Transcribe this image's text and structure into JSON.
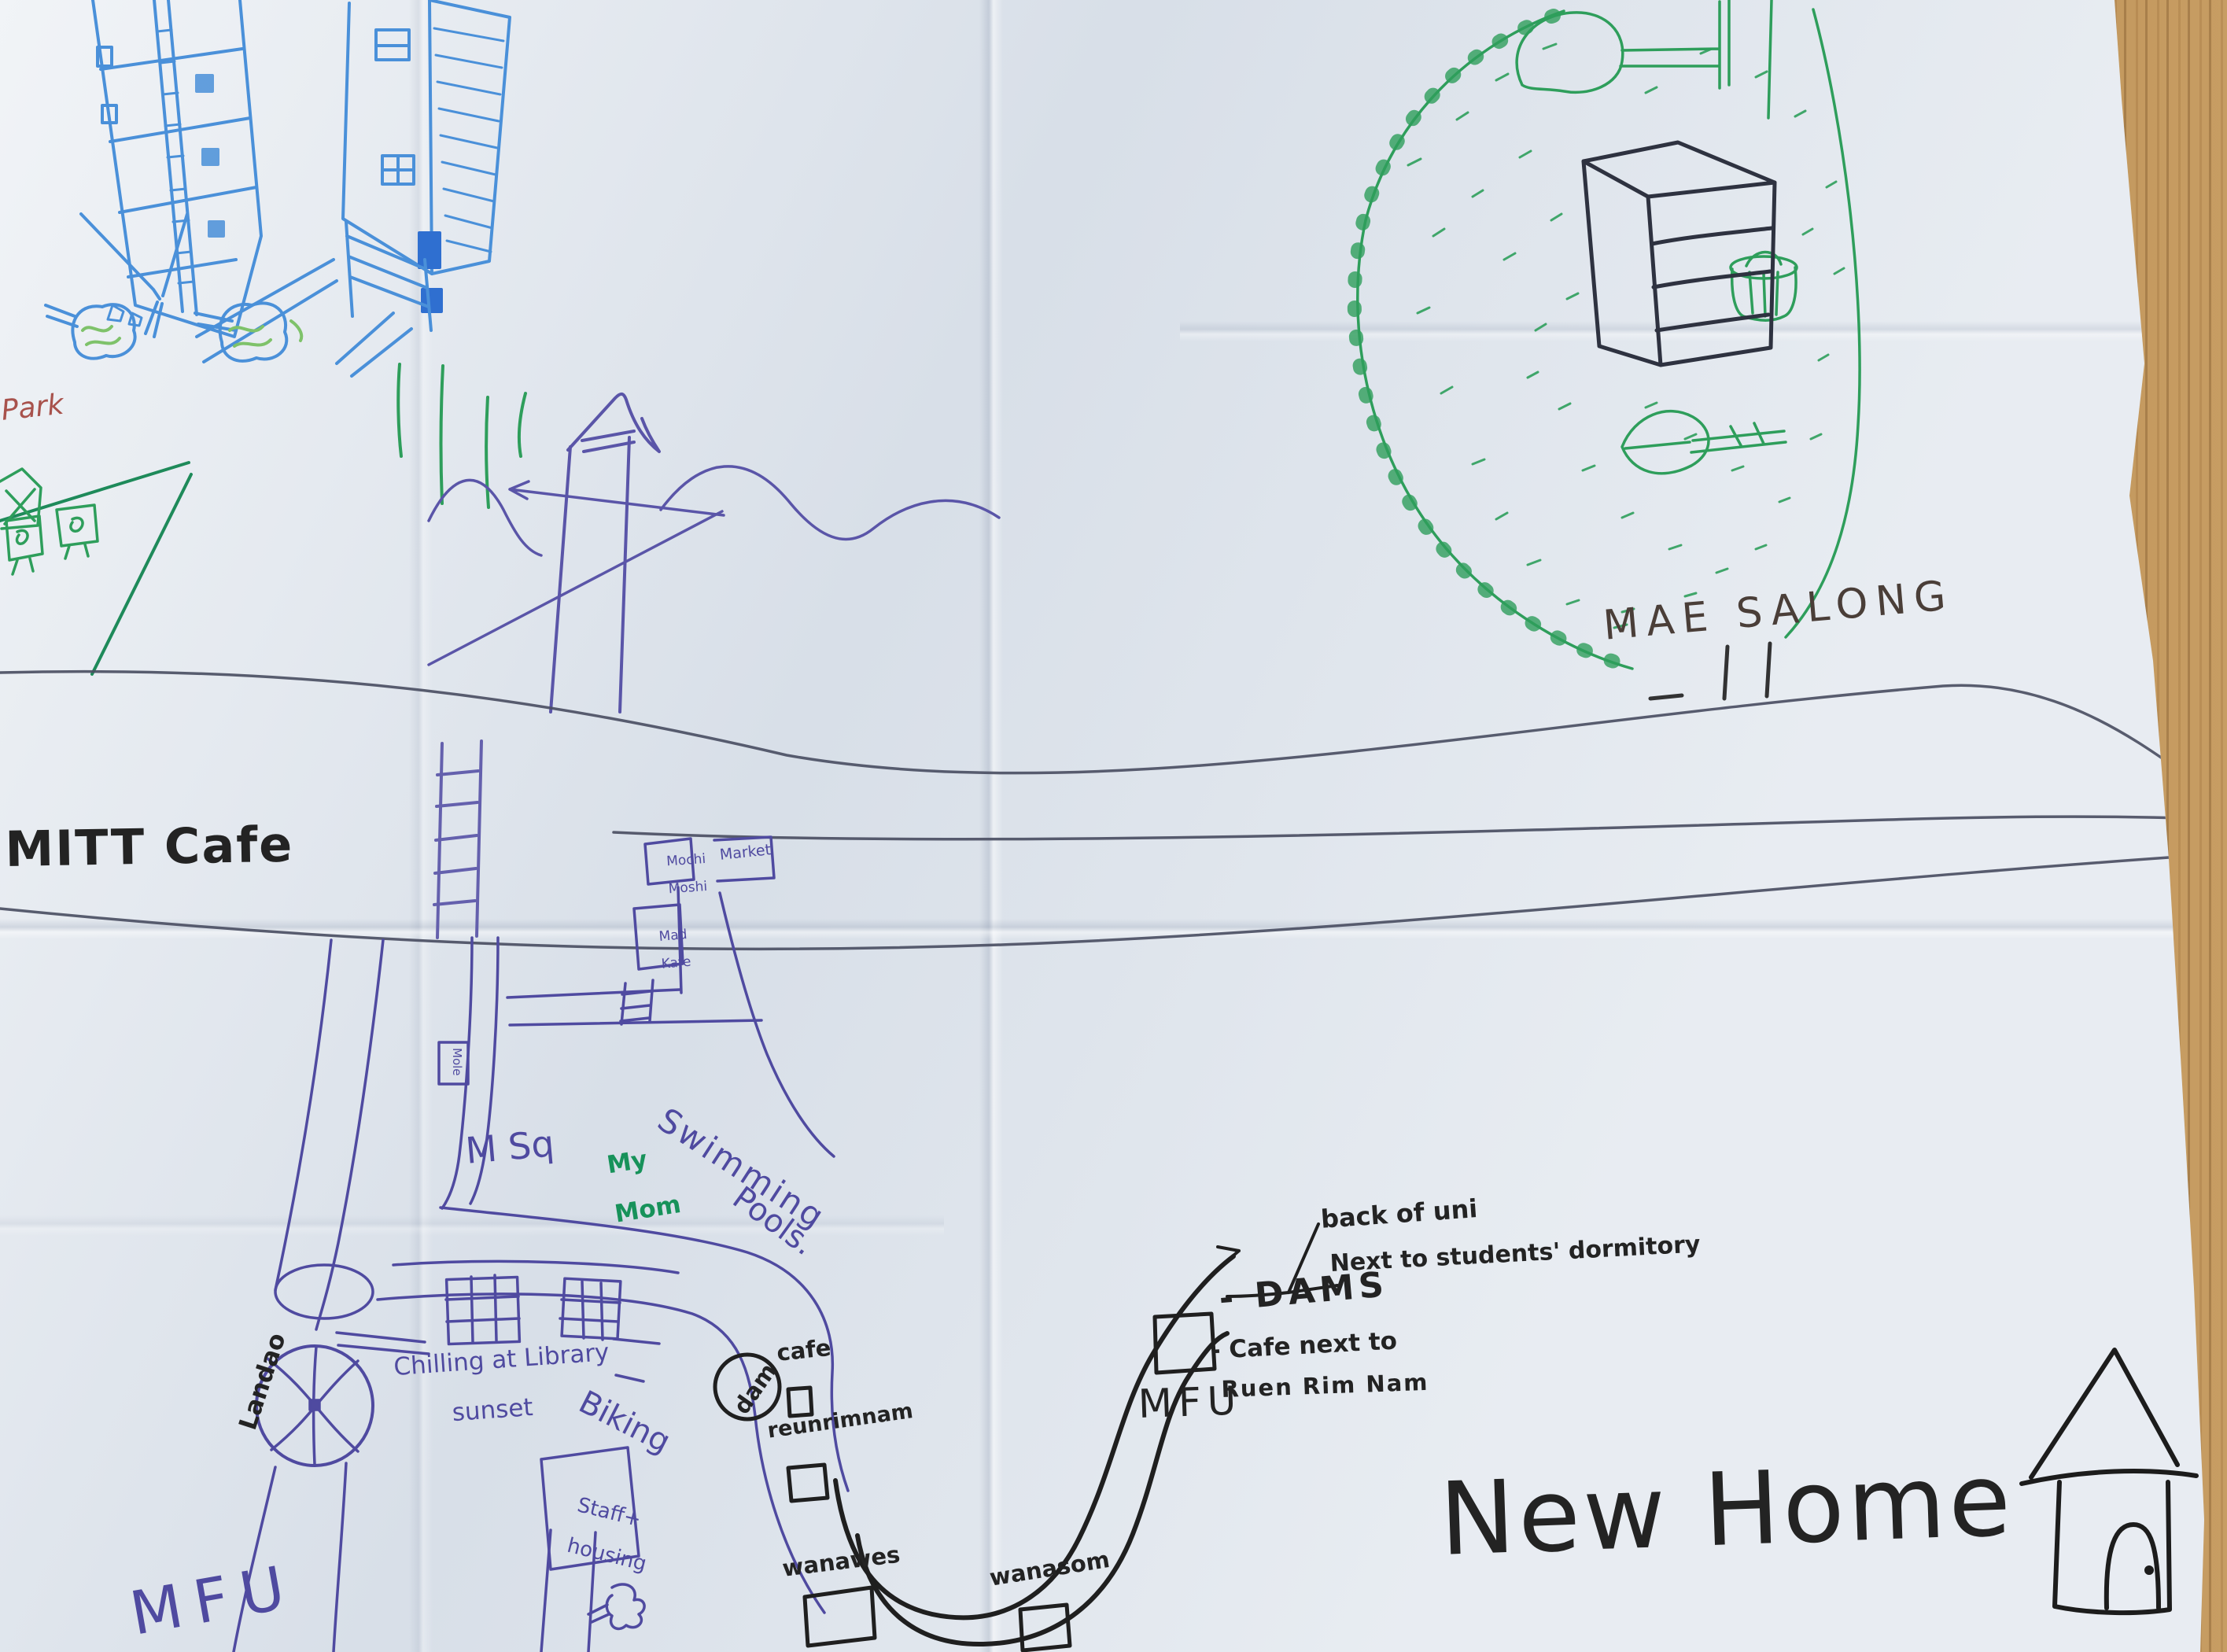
{
  "scene": {
    "surface": "wood-table",
    "colors": {
      "paper": "#e0e6ed",
      "wood": "#b5854a",
      "ink_black": "#232323",
      "ink_purple": "#4f4aa0",
      "ink_blue": "#4a90d9",
      "ink_green": "#2e9e5b",
      "ink_dark_green": "#1e8a5a",
      "ink_red": "#a8524c",
      "road_gray": "#4b4f63"
    }
  },
  "map": {
    "top_left_area": {
      "park_label": "Park"
    },
    "cafe_area": {
      "mitt_cafe_label": "MITT Cafe"
    },
    "mae_salong_area": {
      "name": "MAE SALONG"
    },
    "market_area": {
      "mochi_stall": {
        "line1": "Mochi",
        "line2": "Moshi"
      },
      "market_stall": {
        "label": "Market"
      },
      "mad_kafe_stall": {
        "line1": "Mad",
        "line2": "Kafe"
      },
      "mole_stop": {
        "label": "Mole"
      }
    },
    "campus_area": {
      "m_sq_label": "M Sq",
      "my_mom": {
        "line1": "My",
        "line2": "Mom"
      },
      "swimming": {
        "line1": "Swimming",
        "line2": "Pools."
      },
      "library_note": {
        "line1": "Chilling at Library",
        "line2": "sunset"
      },
      "landao_label": "Landao",
      "biking_label": "Biking",
      "staff_housing": {
        "line1": "Staff+",
        "line2": "housing"
      },
      "mfu_label": "MFU"
    },
    "river_area": {
      "dam_circle_label": "dam",
      "cafe_label": "cafe",
      "reunrimnam_label": "reunrimnam",
      "wanawes_label": "wanawes",
      "wanasom_label": "wanasom"
    },
    "dams_area": {
      "mfu_label": "MFU",
      "dams_note": "- DAMS",
      "cafe_note": {
        "line1": "- Cafe next to",
        "line2": "Ruen Rim Nam"
      },
      "back_of_uni_note": "back of uni",
      "dormitory_note": "Next to students' dormitory"
    },
    "new_home_area": {
      "title": "New Home"
    }
  }
}
